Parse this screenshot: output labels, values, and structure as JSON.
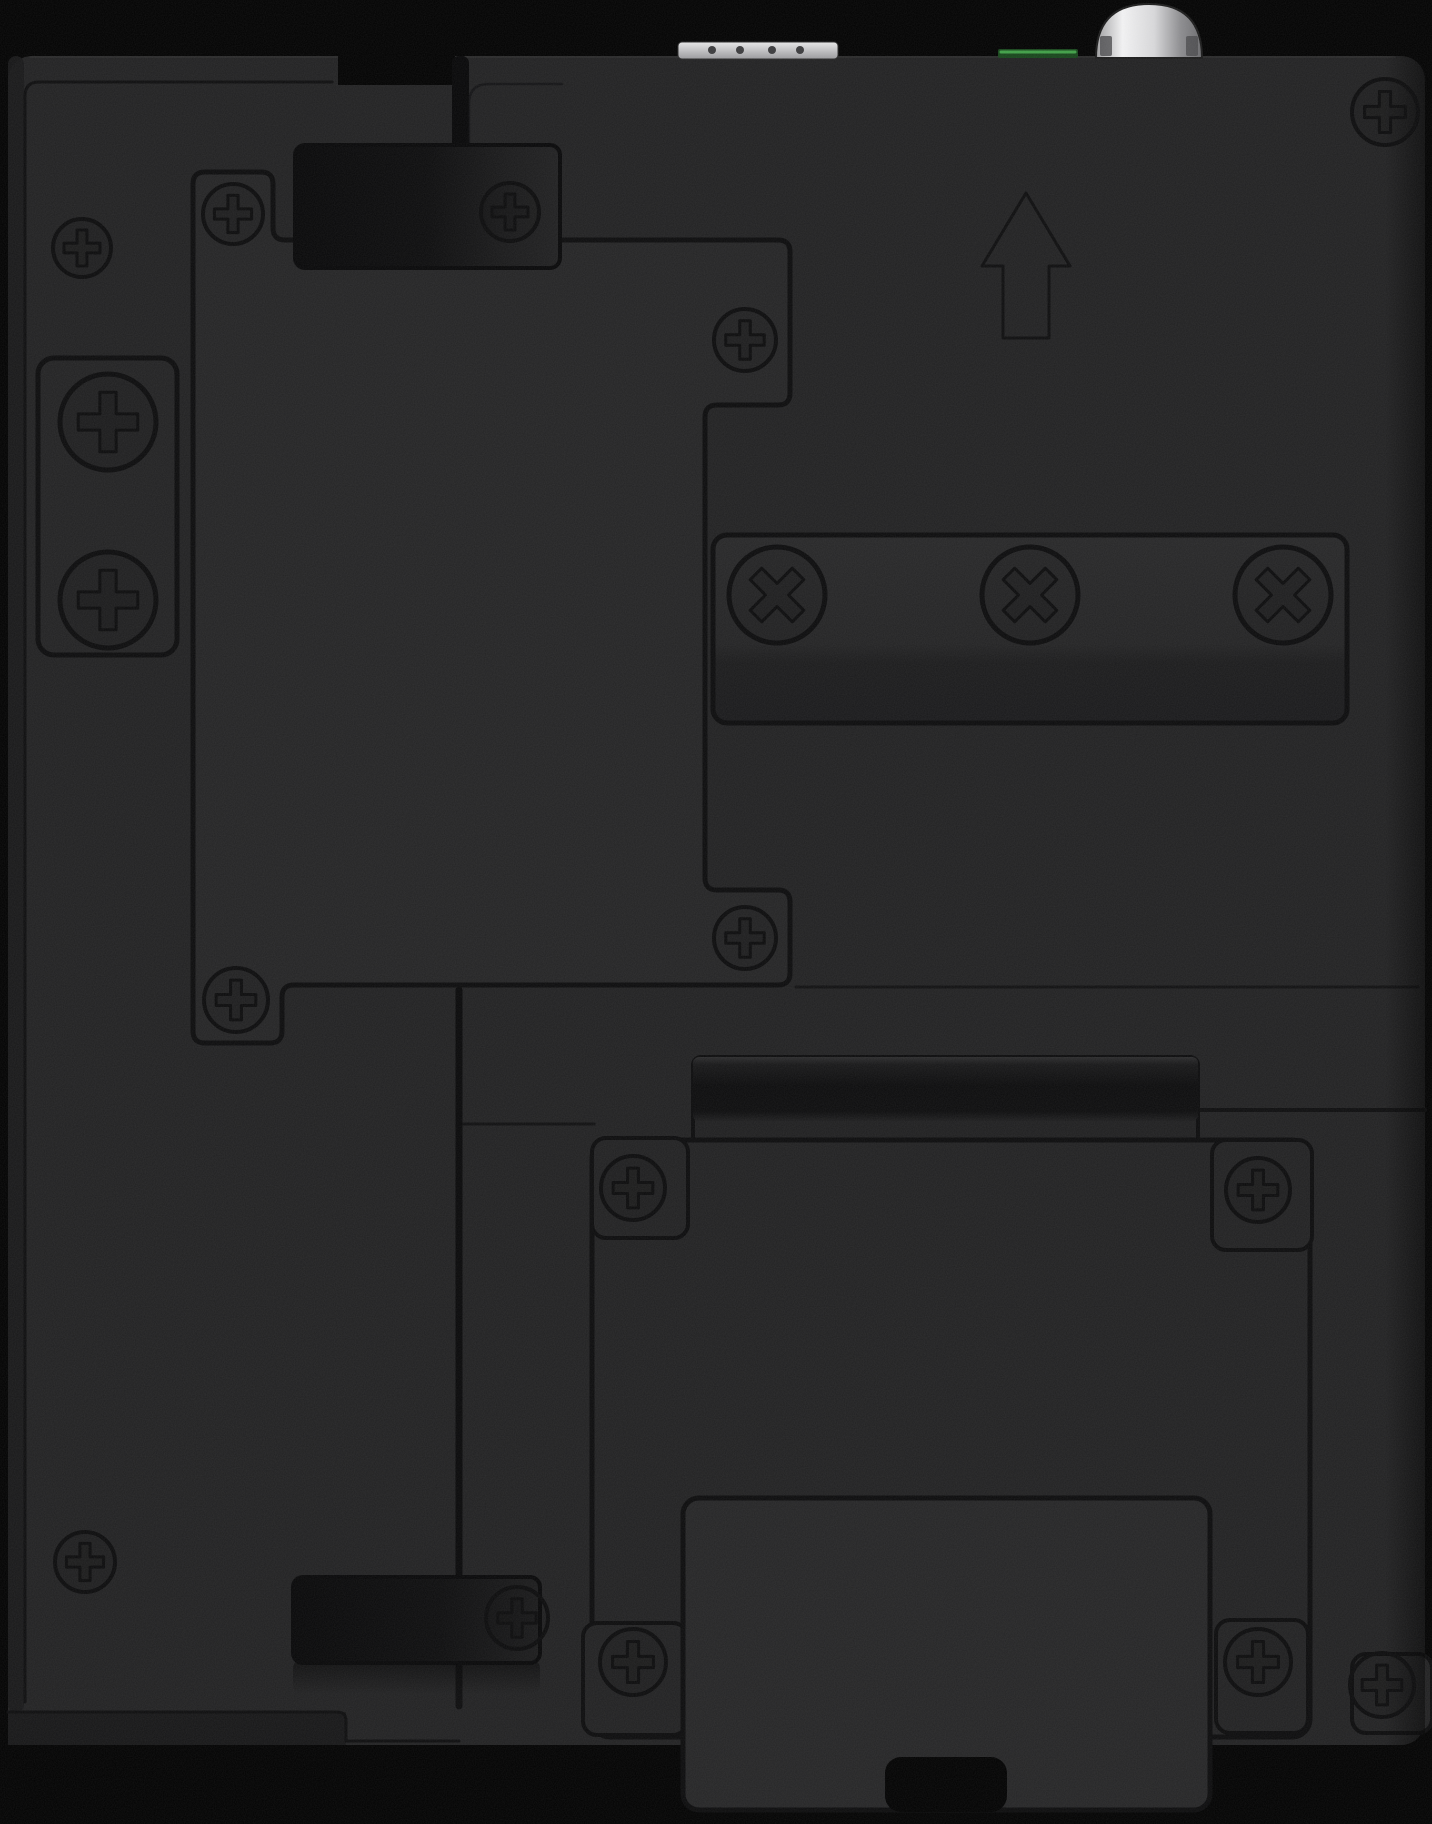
{
  "image": {
    "width": 1432,
    "height": 1824,
    "kind": "product-photo",
    "subject": "back panel of black industrial device with mounting plates, screws and din-rail clip"
  },
  "colors": {
    "page": "#000000",
    "body": "#202021",
    "panel": "#232324",
    "line": "#0a0a0b",
    "slot": "#050506",
    "bevel": "#151516",
    "edgeshade": "#161617",
    "latchstroke": "#060607",
    "hole": "#3a3a3c",
    "greenbase": "#16451a",
    "greenline": "#3fa046",
    "black": "#000000"
  },
  "shapes": [
    {
      "type": "rect",
      "name": "device-body",
      "x": 8,
      "y": 56,
      "w": 1417,
      "h": 1689,
      "rx": 24,
      "fill": "body"
    },
    {
      "type": "path",
      "name": "body-top-highlight",
      "d": "M 30 57 L 1395 57",
      "stroke": "#3a3a3c",
      "sw": 1.2,
      "op": 0.5
    },
    {
      "type": "rect",
      "name": "left-edge-shade",
      "x": 8,
      "y": 56,
      "w": 16,
      "h": 1657,
      "rx": 8,
      "fill": "edgeshade",
      "op": 0.9
    },
    {
      "type": "path",
      "name": "left-plate-groove",
      "d": "M 25 1702 L 25 96 Q 25 82 39 82 L 332 82",
      "stroke": "line",
      "sw": 3,
      "op": 0.9
    },
    {
      "type": "rect",
      "name": "top-step-cut",
      "x": 338,
      "y": 56,
      "w": 117,
      "h": 29,
      "rx": 0,
      "fill": "black"
    },
    {
      "type": "rect",
      "name": "top-seam-slot",
      "x": 452,
      "y": 56,
      "w": 17,
      "h": 102,
      "rx": 7,
      "fill": "slot"
    },
    {
      "type": "path",
      "name": "right-plate-corner-seam",
      "d": "M 469 152 L 469 104 Q 469 84 489 84 L 562 84",
      "stroke": "line",
      "sw": 2.5,
      "op": 0.6
    },
    {
      "type": "path",
      "name": "mid-horizontal-seam",
      "d": "M 796 987 L 1418 987",
      "stroke": "line",
      "sw": 3,
      "op": 0.75
    },
    {
      "type": "path",
      "name": "right-lower-seam",
      "d": "M 1200 1110 L 1425 1110",
      "stroke": "line",
      "sw": 4,
      "op": 0.9
    },
    {
      "type": "path",
      "name": "left-lower-seam",
      "d": "M 462 1124 L 594 1124",
      "stroke": "line",
      "sw": 3,
      "op": 0.8
    },
    {
      "type": "path",
      "name": "vertical-main-seam",
      "d": "M 459 990 L 459 1576",
      "stroke": "#060607",
      "sw": 7,
      "op": 0.95
    },
    {
      "type": "path",
      "name": "vertical-main-seam-lower",
      "d": "M 459 1662 L 459 1706",
      "stroke": "#060607",
      "sw": 7,
      "op": 0.8
    },
    {
      "type": "rect",
      "name": "bottom-left-bevel",
      "x": 8,
      "y": 1712,
      "w": 338,
      "h": 33,
      "rx": 0,
      "fill": "bevel"
    },
    {
      "type": "path",
      "name": "bottom-left-edge",
      "d": "M 8 1712 L 337 1712 Q 346 1712 346 1721 L 346 1741 L 459 1741",
      "stroke": "line",
      "sw": 3,
      "op": 0.9
    },
    {
      "type": "path",
      "name": "central-cover-panel",
      "d": "M 205 172 L 261 172 Q 273 172 273 184 L 273 228 Q 273 240 285 240 L 778 240 Q 790 240 790 252 L 790 393 Q 790 405 778 405 L 717 405 Q 705 405 705 417 L 705 878 Q 705 890 717 890 L 778 890 Q 790 890 790 902 L 790 973 Q 790 985 778 985 L 294 985 Q 282 985 282 997 L 282 1031 Q 282 1043 270 1043 L 205 1043 Q 193 1043 193 1031 L 193 184 Q 193 172 205 172 Z",
      "fill": "panel",
      "stroke": "line",
      "sw": 5
    },
    {
      "type": "rect",
      "name": "left-screw-bracket",
      "x": 38,
      "y": 358,
      "w": 139,
      "h": 297,
      "rx": 16,
      "fill": "#212122",
      "stroke": "line",
      "sw": 5
    },
    {
      "type": "rect",
      "name": "x-screw-bracket",
      "x": 713,
      "y": 535,
      "w": 634,
      "h": 188,
      "rx": 14,
      "fill": "url(#bracketGrad)",
      "stroke": "line",
      "sw": 5
    },
    {
      "type": "rect",
      "name": "hinge-plate",
      "x": 693,
      "y": 1057,
      "w": 505,
      "h": 135,
      "rx": 8,
      "fill": "#1e1e1f",
      "stroke": "line",
      "sw": 4
    },
    {
      "type": "rect",
      "name": "hinge-bar",
      "x": 693,
      "y": 1057,
      "w": 505,
      "h": 64,
      "rx": 6,
      "fill": "url(#hingeGrad)"
    },
    {
      "type": "rect",
      "name": "bottom-mount-plate",
      "x": 592,
      "y": 1140,
      "w": 718,
      "h": 597,
      "rx": 18,
      "fill": "body",
      "stroke": "line",
      "sw": 5
    },
    {
      "type": "rect",
      "name": "plate-corner-tab-top-left",
      "x": 592,
      "y": 1138,
      "w": 96,
      "h": 100,
      "rx": 14,
      "fill": "body",
      "stroke": "line",
      "sw": 4
    },
    {
      "type": "rect",
      "name": "plate-corner-tab-top-right",
      "x": 1212,
      "y": 1140,
      "w": 100,
      "h": 110,
      "rx": 14,
      "fill": "body",
      "stroke": "line",
      "sw": 4
    },
    {
      "type": "rect",
      "name": "plate-corner-tab-bottom-left",
      "x": 583,
      "y": 1623,
      "w": 104,
      "h": 112,
      "rx": 14,
      "fill": "body",
      "stroke": "line",
      "sw": 4
    },
    {
      "type": "rect",
      "name": "plate-corner-tab-bottom-right",
      "x": 1216,
      "y": 1620,
      "w": 92,
      "h": 113,
      "rx": 14,
      "fill": "body",
      "stroke": "line",
      "sw": 4
    },
    {
      "type": "rect",
      "name": "right-edge-corner-tab",
      "x": 1352,
      "y": 1654,
      "w": 80,
      "h": 79,
      "rx": 14,
      "fill": "body",
      "stroke": "line",
      "sw": 4
    },
    {
      "type": "rect",
      "name": "din-rail-clip",
      "x": 683,
      "y": 1498,
      "w": 527,
      "h": 312,
      "rx": 16,
      "fill": "#242425",
      "stroke": "line",
      "sw": 5
    },
    {
      "type": "rect",
      "name": "din-clip-notch",
      "x": 885,
      "y": 1757,
      "w": 122,
      "h": 55,
      "rx": 16,
      "fill": "black"
    },
    {
      "type": "rect",
      "name": "top-mount-latch",
      "x": 295,
      "y": 145,
      "w": 265,
      "h": 123,
      "rx": 10,
      "fill": "url(#latchGrad)",
      "stroke": "latchstroke",
      "sw": 4
    },
    {
      "type": "rect",
      "name": "bottom-latch-shadow",
      "x": 293,
      "y": 1660,
      "w": 247,
      "h": 34,
      "rx": 8,
      "fill": "url(#fadeDown)",
      "op": 0.6
    },
    {
      "type": "rect",
      "name": "bottom-mount-latch",
      "x": 293,
      "y": 1577,
      "w": 247,
      "h": 86,
      "rx": 10,
      "fill": "url(#latchGradB)",
      "stroke": "latchstroke",
      "sw": 4
    },
    {
      "type": "path",
      "name": "up-arrow-icon",
      "d": "M 1026 193 L 1070 266 L 1049 266 L 1049 338 L 1003 338 L 1003 266 L 982 266 Z",
      "stroke": "#0c0c0d",
      "sw": 3,
      "op": 1
    },
    {
      "type": "rect",
      "name": "terminal-block-connector",
      "x": 678,
      "y": 42,
      "w": 160,
      "h": 17,
      "rx": 4,
      "fill": "url(#silverGrad)",
      "stroke": "#2a2a2a",
      "sw": 1
    },
    {
      "type": "circles",
      "name": "terminal-block-hole",
      "cx": [
        712,
        740,
        772,
        800
      ],
      "cy": 50,
      "r": 4,
      "fill": "hole"
    },
    {
      "type": "rect",
      "name": "green-connector-edge",
      "x": 998,
      "y": 49,
      "w": 80,
      "h": 9,
      "rx": 2,
      "fill": "greenbase"
    },
    {
      "type": "path",
      "name": "green-connector-highlight",
      "d": "M 1001 52 L 1075 52",
      "stroke": "greenline",
      "sw": 3,
      "op": 1
    },
    {
      "type": "rect",
      "name": "antenna-connector-flange",
      "x": 1099,
      "y": 30,
      "w": 100,
      "h": 28,
      "rx": 3,
      "fill": "url(#domeSideGrad)"
    },
    {
      "type": "path",
      "name": "antenna-connector-cap",
      "d": "M 1096 58 Q 1096 4 1149 4 Q 1202 4 1202 58 Z",
      "fill": "url(#domeGrad)",
      "stroke": "#1a1a1a",
      "sw": 2
    },
    {
      "type": "rect",
      "name": "antenna-flange-notch-left",
      "x": 1100,
      "y": 36,
      "w": 12,
      "h": 20,
      "rx": 2,
      "fill": "#4a4a4c",
      "op": 0.8
    },
    {
      "type": "rect",
      "name": "antenna-flange-notch-right",
      "x": 1186,
      "y": 36,
      "w": 12,
      "h": 20,
      "rx": 2,
      "fill": "#4a4a4c",
      "op": 0.8
    },
    {
      "type": "rect",
      "name": "right-edge-vignette",
      "x": 1385,
      "y": 56,
      "w": 40,
      "h": 1689,
      "rx": 0,
      "fill": "url(#fadeRight)",
      "op": 0.55
    }
  ],
  "screws": [
    {
      "style": "phillips",
      "name": "screw-left-plate-top",
      "x": 82,
      "y": 248,
      "r": 29
    },
    {
      "style": "phillips",
      "name": "screw-panel-top-left",
      "x": 233,
      "y": 214,
      "r": 30
    },
    {
      "style": "phillips",
      "name": "screw-top-latch",
      "x": 510,
      "y": 212,
      "r": 29
    },
    {
      "style": "phillips",
      "name": "screw-body-top-right",
      "x": 1385,
      "y": 112,
      "r": 33
    },
    {
      "style": "phillips",
      "name": "screw-panel-top-right",
      "x": 745,
      "y": 340,
      "r": 31
    },
    {
      "style": "phillips",
      "name": "screw-panel-bottom-right",
      "x": 745,
      "y": 938,
      "r": 31
    },
    {
      "style": "phillips",
      "name": "screw-panel-bottom-left",
      "x": 236,
      "y": 1000,
      "r": 32
    },
    {
      "style": "phillips-large",
      "name": "screw-left-bracket-upper",
      "x": 108,
      "y": 422,
      "r": 48
    },
    {
      "style": "phillips-large",
      "name": "screw-left-bracket-lower",
      "x": 108,
      "y": 600,
      "r": 48
    },
    {
      "style": "xcross",
      "name": "x-screw-bracket-left",
      "x": 777,
      "y": 595,
      "r": 48
    },
    {
      "style": "xcross",
      "name": "x-screw-bracket-middle",
      "x": 1030,
      "y": 595,
      "r": 48
    },
    {
      "style": "xcross",
      "name": "x-screw-bracket-right",
      "x": 1283,
      "y": 595,
      "r": 48
    },
    {
      "style": "phillips",
      "name": "screw-plate-top-left",
      "x": 633,
      "y": 1188,
      "r": 32
    },
    {
      "style": "phillips",
      "name": "screw-plate-top-right",
      "x": 1258,
      "y": 1190,
      "r": 32
    },
    {
      "style": "phillips",
      "name": "screw-plate-bottom-left",
      "x": 633,
      "y": 1662,
      "r": 33
    },
    {
      "style": "phillips",
      "name": "screw-plate-bottom-right",
      "x": 1258,
      "y": 1662,
      "r": 33
    },
    {
      "style": "phillips",
      "name": "screw-right-edge-bottom",
      "x": 1382,
      "y": 1685,
      "r": 32
    },
    {
      "style": "phillips",
      "name": "screw-left-plate-bottom",
      "x": 85,
      "y": 1562,
      "r": 30
    },
    {
      "style": "phillips",
      "name": "screw-bottom-latch",
      "x": 517,
      "y": 1618,
      "r": 31
    }
  ]
}
